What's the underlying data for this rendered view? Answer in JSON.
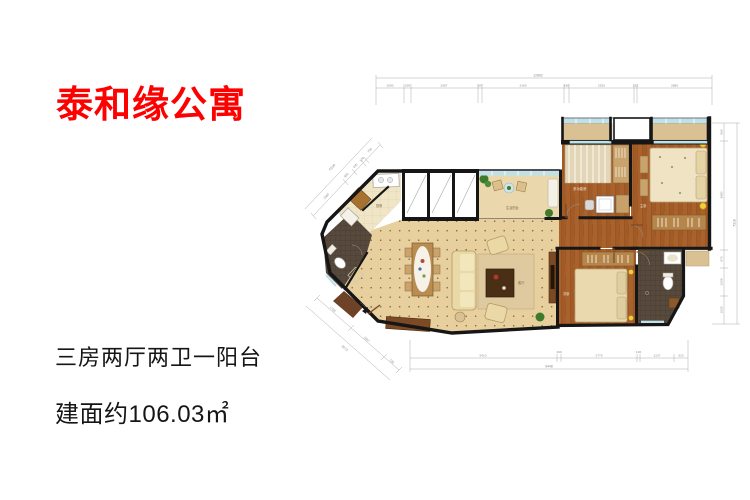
{
  "title": "泰和缘公寓",
  "layout_text": "三房两厅两卫一阳台",
  "area_text": "建面约106.03㎡",
  "floorplan": {
    "rooms": {
      "kitchen": "厨房",
      "balcony": "生活阳台",
      "living": "客厅",
      "multi": "多功能房",
      "master": "主卧",
      "second": "次卧"
    },
    "dims": {
      "top": {
        "total": "12862",
        "segments": [
          "1090",
          "239",
          "2587",
          "167",
          "3160",
          "180",
          "2520",
          "122",
          "2880"
        ]
      },
      "right": {
        "total": "7318",
        "segments": [
          "660",
          "3980",
          "670",
          "1008",
          "1029"
        ]
      },
      "bottom": {
        "total": "9448",
        "segments": [
          "5410",
          "160",
          "2779",
          "120",
          "1237",
          "523"
        ]
      },
      "left_diag": {
        "total": "6510",
        "segments": [
          "1560",
          "450",
          "430",
          "120",
          "700"
        ]
      },
      "bottom_left_diag": {
        "total": "4073",
        "segments": [
          "1700",
          "1657",
          "730"
        ]
      }
    },
    "colors": {
      "accent_red": "#fe0000",
      "text_dark": "#151515",
      "wall": "#161616",
      "living_floor_tan": "#e7cf9e",
      "wood_floor": "#a9622c",
      "kitchen_tile": "#f0e5c6",
      "bath_mosaic": "#57493c",
      "window_blue": "#bfe1ea",
      "sill_tan": "#d9c194",
      "sofa_cream": "#ead9a6",
      "plant_green": "#3e7a2c",
      "lamp_yellow": "#f2cf3a",
      "dim_gray": "#8a8a8a"
    }
  }
}
